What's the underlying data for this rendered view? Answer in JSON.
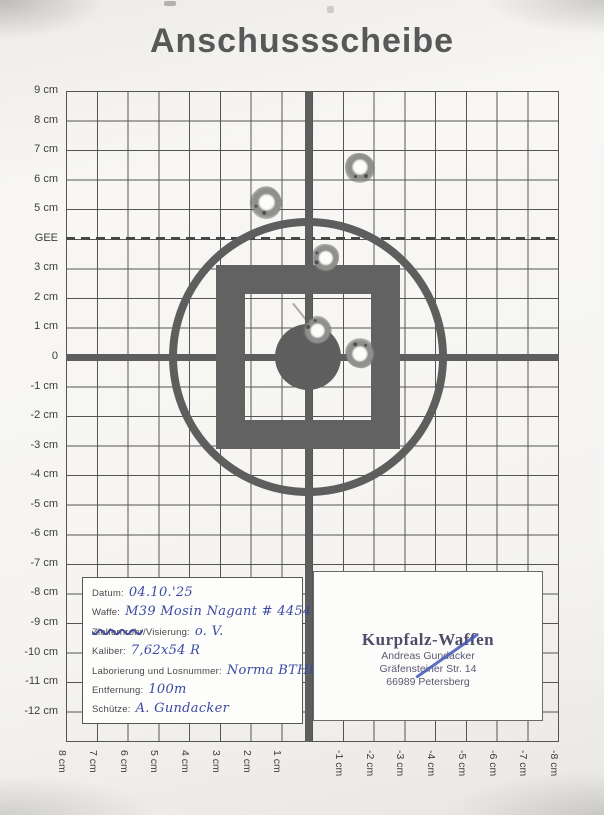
{
  "page": {
    "title": "Anschussscheibe"
  },
  "colors": {
    "handwriting_ink": "#3b4aa2",
    "stamp_ink": "#565678",
    "pen_stroke": "#4357b5",
    "target_gray": "#5e5e5e",
    "grid_line": "#555555",
    "paper": "#f5f4f1"
  },
  "target": {
    "left_axis": [
      {
        "cm": 9,
        "label": "9 cm"
      },
      {
        "cm": 8,
        "label": "8 cm"
      },
      {
        "cm": 7,
        "label": "7 cm"
      },
      {
        "cm": 6,
        "label": "6 cm"
      },
      {
        "cm": 5,
        "label": "5 cm"
      },
      {
        "cm": 4,
        "label": "GEE"
      },
      {
        "cm": 3,
        "label": "3 cm"
      },
      {
        "cm": 2,
        "label": "2 cm"
      },
      {
        "cm": 1,
        "label": "1 cm"
      },
      {
        "cm": 0,
        "label": "0"
      },
      {
        "cm": -1,
        "label": "-1 cm"
      },
      {
        "cm": -2,
        "label": "-2 cm"
      },
      {
        "cm": -3,
        "label": "-3 cm"
      },
      {
        "cm": -4,
        "label": "-4 cm"
      },
      {
        "cm": -5,
        "label": "-5 cm"
      },
      {
        "cm": -6,
        "label": "-6 cm"
      },
      {
        "cm": -7,
        "label": "-7 cm"
      },
      {
        "cm": -8,
        "label": "-8 cm"
      },
      {
        "cm": -9,
        "label": "-9 cm"
      },
      {
        "cm": -10,
        "label": "-10 cm"
      },
      {
        "cm": -11,
        "label": "-11 cm"
      },
      {
        "cm": -12,
        "label": "-12 cm"
      }
    ],
    "bottom_axis": [
      {
        "cm": 8,
        "label": "8 cm"
      },
      {
        "cm": 7,
        "label": "7 cm"
      },
      {
        "cm": 6,
        "label": "6 cm"
      },
      {
        "cm": 5,
        "label": "5 cm"
      },
      {
        "cm": 4,
        "label": "4 cm"
      },
      {
        "cm": 3,
        "label": "3 cm"
      },
      {
        "cm": 2,
        "label": "2 cm"
      },
      {
        "cm": 1,
        "label": "1 cm"
      },
      {
        "cm": -1,
        "label": "-1 cm"
      },
      {
        "cm": -2,
        "label": "-2 cm"
      },
      {
        "cm": -3,
        "label": "-3 cm"
      },
      {
        "cm": -4,
        "label": "-4 cm"
      },
      {
        "cm": -5,
        "label": "-5 cm"
      },
      {
        "cm": -6,
        "label": "-6 cm"
      },
      {
        "cm": -7,
        "label": "-7 cm"
      },
      {
        "cm": -8,
        "label": "-8 cm"
      }
    ],
    "bullet_holes": [
      {
        "x_cm": -1.7,
        "y_cm": 6.4,
        "r": 15
      },
      {
        "x_cm": 1.35,
        "y_cm": 5.2,
        "r": 16
      },
      {
        "x_cm": -0.55,
        "y_cm": 3.35,
        "r": 14
      },
      {
        "x_cm": -0.3,
        "y_cm": 0.9,
        "r": 14,
        "drip": 26
      },
      {
        "x_cm": -1.7,
        "y_cm": 0.15,
        "r": 15
      }
    ]
  },
  "info_box": {
    "rows": [
      {
        "label": "Datum:",
        "value": "04.10.'25"
      },
      {
        "label": "Waffe:",
        "value": "M39 Mosin Nagant # 44547"
      },
      {
        "struck": "Zielfernrohr",
        "label": "/Visierung:",
        "value": "o. V."
      },
      {
        "label": "Kaliber:",
        "value": "7,62x54 R"
      },
      {
        "label": "Laborierung und Losnummer:",
        "value": "Norma BTHP"
      },
      {
        "label": "Entfernung:",
        "value": "100m"
      },
      {
        "label": "Schütze:",
        "value": "A. Gundacker"
      }
    ]
  },
  "stamp": {
    "name": "Kurpfalz-Waffen",
    "line2": "Andreas Gundacker",
    "line3": "Gräfensteiner Str. 14",
    "line4": "66989 Petersberg"
  }
}
